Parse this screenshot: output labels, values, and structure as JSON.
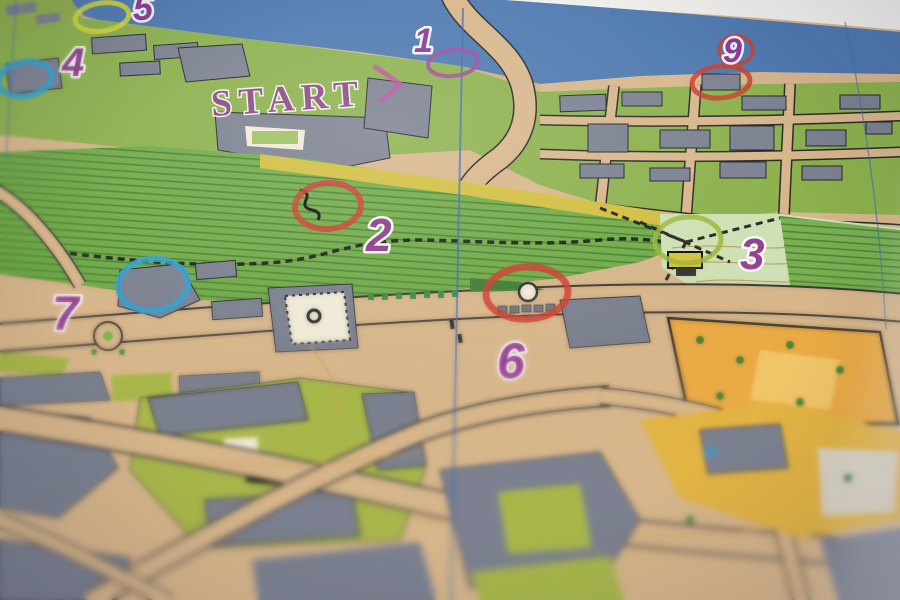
{
  "map": {
    "start_label": "START",
    "number_color": "#8e3490",
    "controls": [
      {
        "number": "1",
        "color": "#a4479f",
        "cx": 453,
        "cy": 63,
        "rx": 25,
        "ry": 13,
        "rot": -6,
        "sw": 4,
        "nx": 414,
        "ny": 52,
        "fs": 34
      },
      {
        "number": "2",
        "color": "#cc3d2e",
        "cx": 328,
        "cy": 206,
        "rx": 33,
        "ry": 23,
        "rot": -4,
        "sw": 6,
        "nx": 366,
        "ny": 251,
        "fs": 46
      },
      {
        "number": "3",
        "color": "#9db63a",
        "cx": 688,
        "cy": 240,
        "rx": 33,
        "ry": 23,
        "rot": -4,
        "sw": 5,
        "nx": 740,
        "ny": 269,
        "fs": 44
      },
      {
        "number": "4",
        "color": "#31a2d4",
        "cx": 25,
        "cy": 79,
        "rx": 27,
        "ry": 17,
        "rot": -10,
        "sw": 6,
        "nx": 62,
        "ny": 76,
        "fs": 40
      },
      {
        "number": "5",
        "color": "#d5d935",
        "cx": 102,
        "cy": 17,
        "rx": 27,
        "ry": 14,
        "rot": -8,
        "sw": 5,
        "nx": 133,
        "ny": 20,
        "fs": 36
      },
      {
        "number": "6",
        "color": "#cc3d2e",
        "cx": 527,
        "cy": 293,
        "rx": 41,
        "ry": 26,
        "rot": -3,
        "sw": 7,
        "nx": 497,
        "ny": 378,
        "fs": 50
      },
      {
        "number": "7",
        "color": "#31a2d4",
        "cx": 153,
        "cy": 285,
        "rx": 35,
        "ry": 26,
        "rot": -5,
        "sw": 6,
        "nx": 52,
        "ny": 330,
        "fs": 48
      },
      {
        "number": "9",
        "color": "#cc3d2e",
        "cx": 721,
        "cy": 82,
        "rx": 29,
        "ry": 16,
        "rot": -5,
        "sw": 5,
        "nx": 723,
        "ny": 62,
        "fs": 34,
        "number_ring": {
          "cx": 736,
          "cy": 50,
          "rx": 17,
          "ry": 14
        }
      }
    ],
    "colors": {
      "sea": "#4e79b0",
      "paper": "#f2f1ed",
      "road_tan": "#d7b68b",
      "building_gray": "#7c8190",
      "grass_green": "#7fb44e",
      "slope_green": "#72aa47",
      "olive_green": "#a9b74b",
      "pale_green": "#cfe0b4",
      "yellow_open": "#e2b445",
      "orange_park": "#eaaa46",
      "overprint_purple": "#8e3490",
      "control_red": "#cc3d2e",
      "control_blue": "#31a2d4",
      "control_yellow": "#d5d935",
      "control_olive": "#9db63a"
    }
  }
}
